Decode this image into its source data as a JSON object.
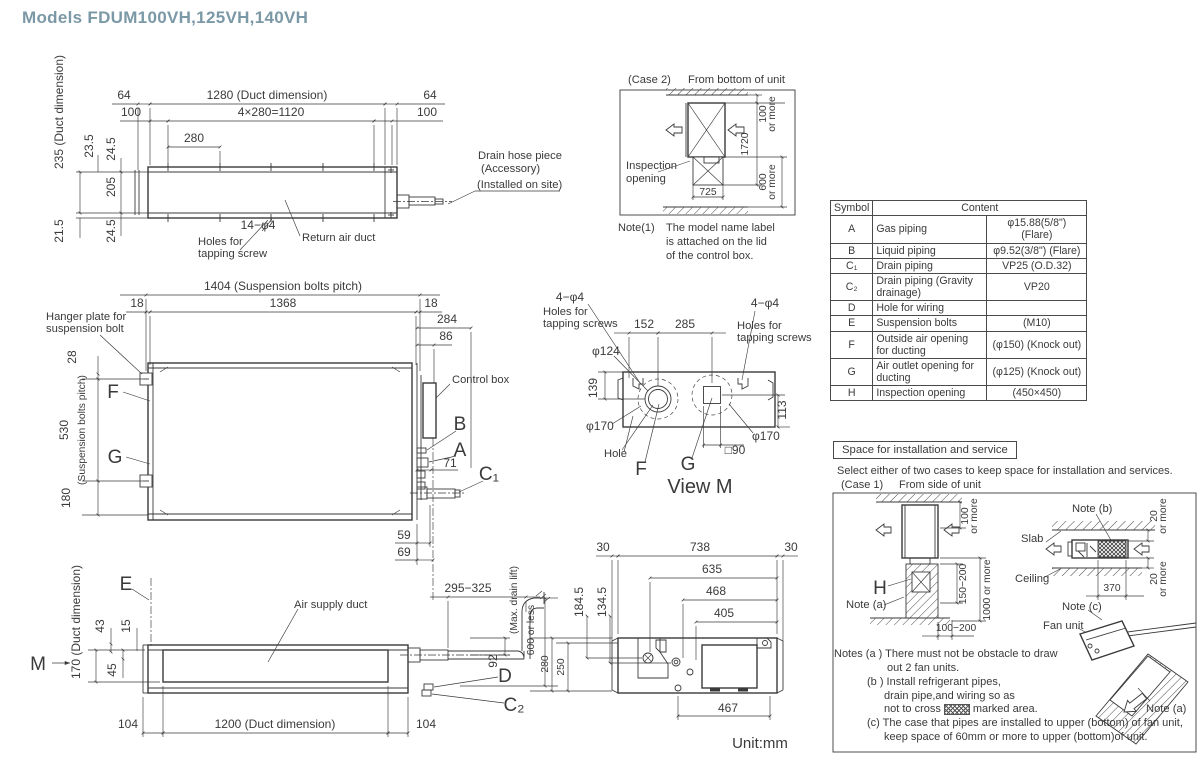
{
  "title": "Models  FDUM100VH,125VH,140VH",
  "unit_label": "Unit:mm",
  "top_view": {
    "dim_64_left": "64",
    "dim_1280": "1280 (Duct dimension)",
    "dim_64_right": "64",
    "dim_100_left": "100",
    "dim_1120": "4×280=1120",
    "dim_100_right": "100",
    "dim_280": "280",
    "dim_235": "235 (Duct dimension)",
    "dim_23_5": "23.5",
    "dim_24_5_top": "24.5",
    "dim_205": "205",
    "dim_21_5": "21.5",
    "dim_24_5_bottom": "24.5",
    "holes_label": "14−φ4",
    "holes_line1": "Holes for",
    "holes_line2": "tapping screw",
    "return_duct": "Return air duct",
    "drain_line1": "Drain hose piece",
    "drain_line2": "(Accessory)",
    "drain_line3": "(Installed on site)"
  },
  "case2": {
    "case_label": "(Case 2)",
    "from_label": "From bottom of unit",
    "inspection_line1": "Inspection",
    "inspection_line2": "opening",
    "dim_100": "100",
    "dim_100_more": "or more",
    "dim_1720": "1720",
    "dim_600": "600",
    "dim_600_more": "or more",
    "dim_725": "725",
    "note_label": "Note(1)",
    "note_line1": "The model name label",
    "note_line2": "is attached on the lid",
    "note_line3": "of the control box."
  },
  "table": {
    "header_symbol": "Symbol",
    "header_content": "Content",
    "rows": [
      {
        "sym": "A",
        "item": "Gas piping",
        "val": "φ15.88(5/8\") (Flare)"
      },
      {
        "sym": "B",
        "item": "Liquid piping",
        "val": "φ9.52(3/8\") (Flare)"
      },
      {
        "sym": "C₁",
        "item": "Drain piping",
        "val": "VP25 (O.D.32)"
      },
      {
        "sym": "C₂",
        "item": "Drain piping (Gravity drainage)",
        "val": "VP20"
      },
      {
        "sym": "D",
        "item": "Hole for wiring",
        "val": ""
      },
      {
        "sym": "E",
        "item": "Suspension bolts",
        "val": "(M10)"
      },
      {
        "sym": "F",
        "item": "Outside air opening for ducting",
        "val": "(φ150) (Knock out)"
      },
      {
        "sym": "G",
        "item": "Air outlet opening for ducting",
        "val": "(φ125) (Knock out)"
      },
      {
        "sym": "H",
        "item": "Inspection opening",
        "val": "(450×450)"
      }
    ]
  },
  "front_view": {
    "dim_1404": "1404 (Suspension bolts pitch)",
    "dim_18_left": "18",
    "dim_1368": "1368",
    "dim_18_right": "18",
    "dim_284": "284",
    "dim_86": "86",
    "hanger_line1": "Hanger plate for",
    "hanger_line2": "suspension bolt",
    "dim_28": "28",
    "dim_530": "530",
    "dim_530_note": "(Suspension bolts pitch)",
    "dim_180": "180",
    "label_f": "F",
    "label_g": "G",
    "control_box": "Control box",
    "label_b": "B",
    "label_a": "A",
    "dim_71": "71",
    "label_c1": "C₁",
    "dim_59": "59",
    "dim_69": "69"
  },
  "view_m": {
    "holes_l_title": "4−φ4",
    "holes_l_line1": "Holes for",
    "holes_l_line2": "tapping screws",
    "holes_r_title": "4−φ4",
    "holes_r_line1": "Holes for",
    "holes_r_line2": "tapping screws",
    "dim_152": "152",
    "dim_285": "285",
    "dim_phi124": "φ124",
    "dim_139": "139",
    "phi170_left": "φ170",
    "phi170_right": "φ170",
    "hole_label": "Hole",
    "label_f": "F",
    "label_g": "G",
    "dim_sq90": "□90",
    "dim_113": "113",
    "title": "View M"
  },
  "side_view": {
    "label_e": "E",
    "label_m": "M",
    "dim_170": "170 (Duct dimension)",
    "dim_43": "43",
    "dim_15": "15",
    "dim_45": "45",
    "air_supply": "Air supply duct",
    "dim_104_left": "104",
    "dim_1200": "1200 (Duct dimension)",
    "dim_104_right": "104",
    "dim_295_325": "295−325",
    "dim_92": "92",
    "label_d": "D",
    "label_c2": "C₂",
    "dim_600_or_less": "600 or less",
    "max_drain": "(Max. drain lift)",
    "dim_280": "280",
    "dim_250": "250"
  },
  "bottom_view": {
    "dim_30_left": "30",
    "dim_738": "738",
    "dim_30_right": "30",
    "dim_635": "635",
    "dim_468": "468",
    "dim_405": "405",
    "dim_184_5": "184.5",
    "dim_134_5": "134.5",
    "dim_467": "467"
  },
  "install": {
    "header": "Space for installation and service",
    "intro": "Select either of two cases to keep space for installation and services.",
    "case_label": "(Case 1)",
    "from_label": "From side of unit",
    "label_h": "H",
    "note_a": "Note (a)",
    "note_b": "Note (b)",
    "note_c": "Note (c)",
    "note_a2": "Note (a)",
    "slab": "Slab",
    "ceiling": "Ceiling",
    "fan_unit": "Fan unit",
    "dim_100": "100",
    "dim_100_more": "or more",
    "dim_150_200": "150−200",
    "dim_1000": "1000 or more",
    "dim_100_200": "100−200",
    "dim_370": "370",
    "dim_20_top": "20",
    "dim_20_top_more": "or more",
    "dim_20_bot": "20",
    "dim_20_bot_more": "or more"
  },
  "notes": {
    "line1": "Notes (a )  There must not be obstacle to draw",
    "line2": "out 2 fan units.",
    "line3": "(b )  Install refrigerant pipes,",
    "line4": "drain pipe,and wiring so as",
    "line5a": "not to cross",
    "line5b": "marked area.",
    "line6": "(c)  The case that pipes are installed to upper (bottom) of fan unit,",
    "line7": "keep space of 60mm or more to upper (bottom)of unit."
  }
}
